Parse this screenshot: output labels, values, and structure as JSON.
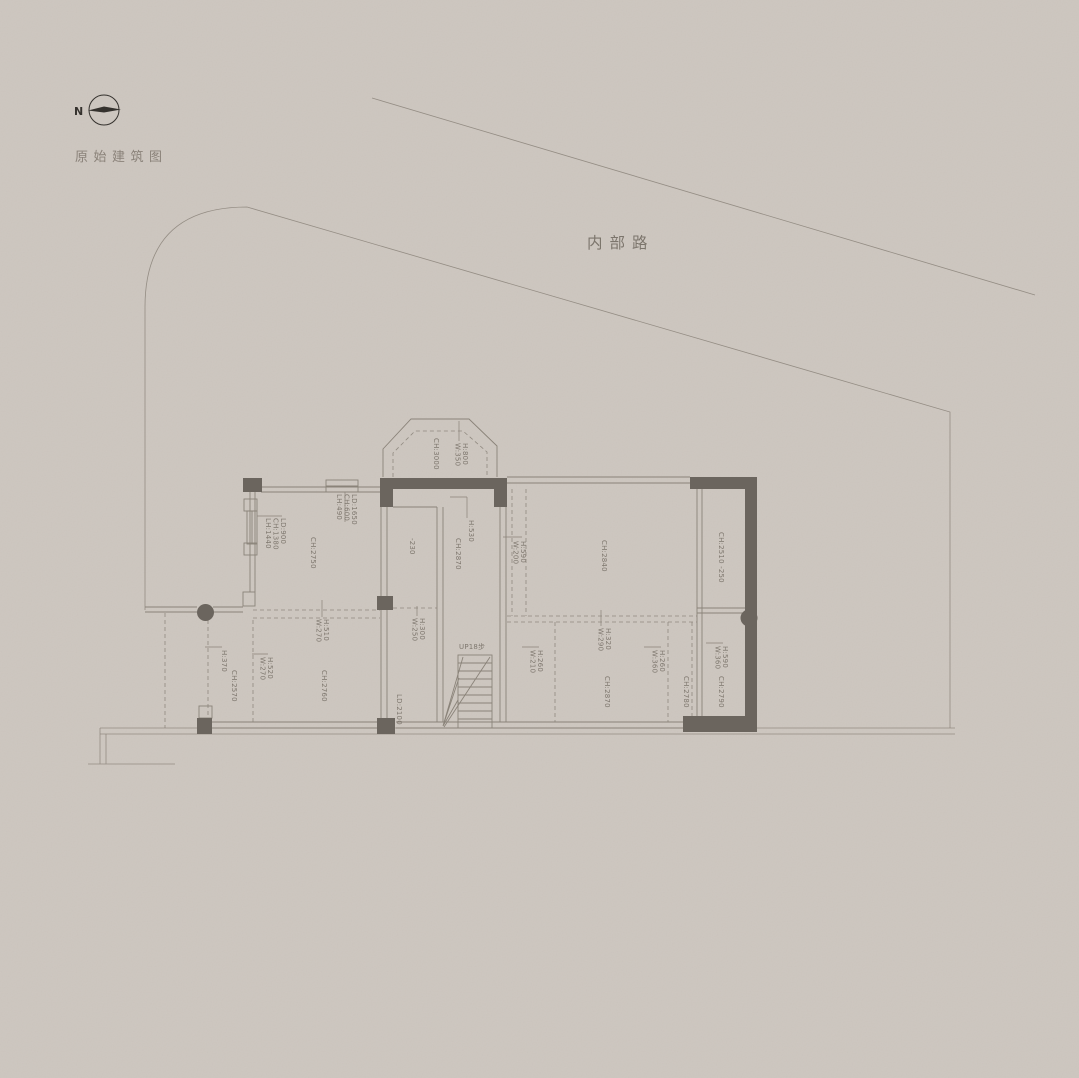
{
  "title": "原始建筑图",
  "compass": {
    "label": "N"
  },
  "road": {
    "label": "内部路"
  },
  "colors": {
    "bg": "#cdc6bf",
    "line": "#8a8379",
    "wall": "#6b655e",
    "text": "#7e776e",
    "dark": "#35322e"
  },
  "plan": {
    "annotations": [
      {
        "lines": [
          "CH:2750"
        ],
        "x": 311,
        "y": 537
      },
      {
        "lines": [
          "LD:900",
          "CH:1380",
          "LH:1440"
        ],
        "x": 281,
        "y": 518
      },
      {
        "lines": [
          "LD:1650",
          "CH:600",
          "LH:490"
        ],
        "x": 352,
        "y": 494
      },
      {
        "lines": [
          "CH:3000"
        ],
        "x": 434,
        "y": 438
      },
      {
        "lines": [
          "H:800",
          "W:350"
        ],
        "x": 463,
        "y": 443
      },
      {
        "lines": [
          "-230"
        ],
        "x": 410,
        "y": 538
      },
      {
        "lines": [
          "CH:2870"
        ],
        "x": 456,
        "y": 538
      },
      {
        "lines": [
          "H:530"
        ],
        "x": 469,
        "y": 520
      },
      {
        "lines": [
          "LD:2100"
        ],
        "x": 397,
        "y": 694
      },
      {
        "lines": [
          "H:300",
          "W:250"
        ],
        "x": 420,
        "y": 618
      },
      {
        "lines": [
          "CH:2840"
        ],
        "x": 602,
        "y": 540
      },
      {
        "lines": [
          "H:590",
          "W:200"
        ],
        "x": 521,
        "y": 541
      },
      {
        "lines": [
          "CH:2510 -250"
        ],
        "x": 719,
        "y": 532
      },
      {
        "lines": [
          "H:260",
          "W:210"
        ],
        "x": 538,
        "y": 650
      },
      {
        "lines": [
          "H:320",
          "W:290"
        ],
        "x": 606,
        "y": 628
      },
      {
        "lines": [
          "CH:2870"
        ],
        "x": 605,
        "y": 676
      },
      {
        "lines": [
          "H:260",
          "W:360"
        ],
        "x": 660,
        "y": 650
      },
      {
        "lines": [
          "CH:2780"
        ],
        "x": 684,
        "y": 676
      },
      {
        "lines": [
          "H:590",
          "W:360"
        ],
        "x": 723,
        "y": 646
      },
      {
        "lines": [
          "CH:2790"
        ],
        "x": 719,
        "y": 676
      },
      {
        "lines": [
          "H:370"
        ],
        "x": 222,
        "y": 650
      },
      {
        "lines": [
          "CH:2570"
        ],
        "x": 232,
        "y": 670
      },
      {
        "lines": [
          "H:520",
          "W:270"
        ],
        "x": 268,
        "y": 657
      },
      {
        "lines": [
          "CH:2760"
        ],
        "x": 322,
        "y": 670
      },
      {
        "lines": [
          "H:510",
          "W:270"
        ],
        "x": 324,
        "y": 619
      },
      {
        "lines": [
          "UP18步"
        ],
        "x": 459,
        "y": 649,
        "rot": false
      }
    ]
  }
}
